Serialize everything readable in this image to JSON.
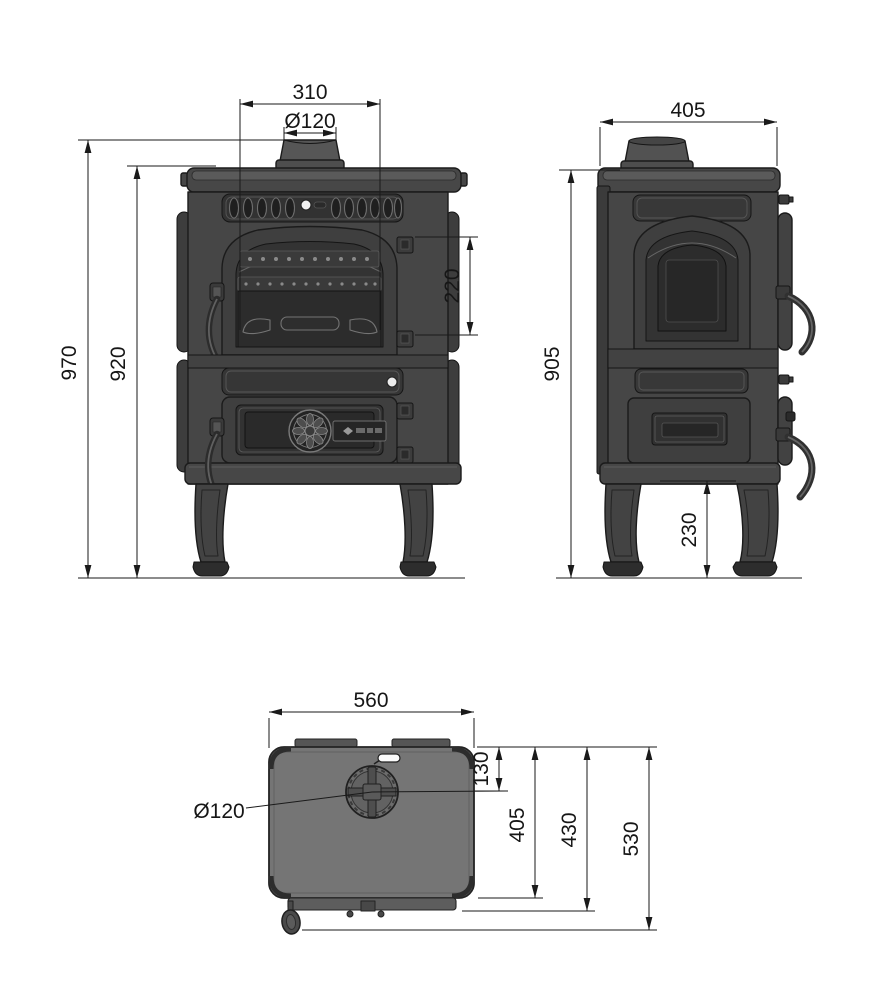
{
  "dims": {
    "front": {
      "width": "310",
      "flue": "Ø120",
      "height_total": "970",
      "height_body": "920",
      "hinge_span": "220"
    },
    "side": {
      "depth": "405",
      "height": "905",
      "leg_height": "230"
    },
    "top": {
      "width": "560",
      "flue_offset": "130",
      "flue": "Ø120",
      "depth_plate": "405",
      "depth_body": "430",
      "depth_total": "530"
    }
  },
  "colors": {
    "background": "#ffffff",
    "dimension_line": "#1a1a1a",
    "body_fill": "#464646",
    "recessed_panel": "#2c2c2c",
    "top_plate_fill": "#757575",
    "white_knob": "#ececec"
  }
}
